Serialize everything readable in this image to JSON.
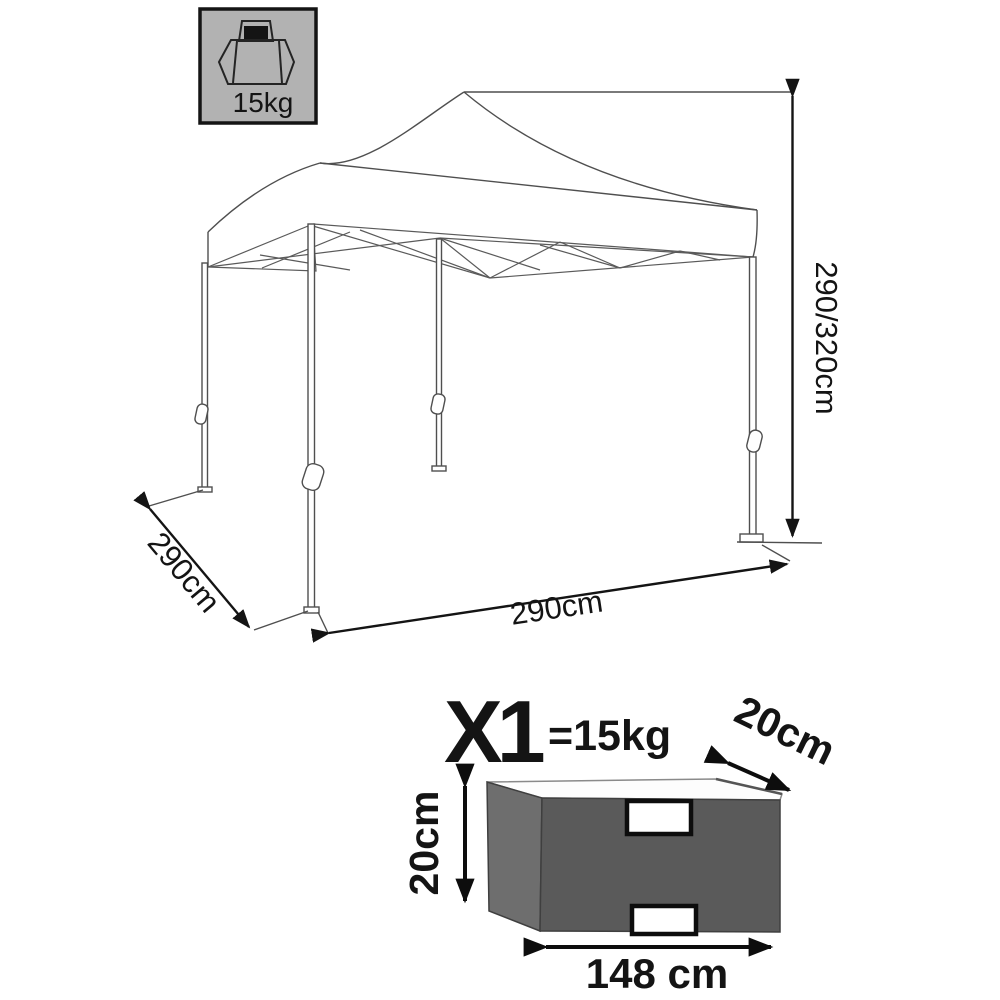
{
  "badge": {
    "weight": "15kg"
  },
  "gazebo_dims": {
    "height": "290/320cm",
    "depth": "290cm",
    "width": "290cm"
  },
  "package": {
    "quantity": "X1",
    "weight": "=15kg",
    "depth": "20cm",
    "height": "20cm",
    "length": "148 cm"
  },
  "colors": {
    "badge_bg": "#b2b2b2",
    "bag_front": "#5a5a5a",
    "bag_side": "#6e6e6e",
    "bag_top": "#fdfdfd",
    "handle": "#ffffff"
  }
}
